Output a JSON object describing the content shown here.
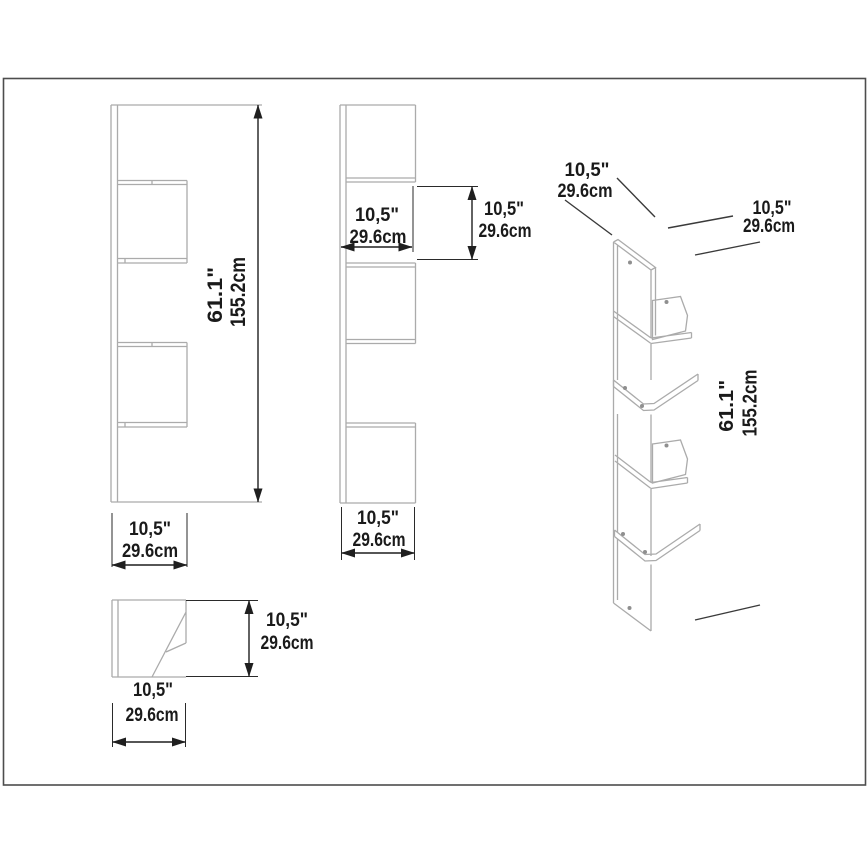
{
  "drawing": {
    "front_view": {
      "height": {
        "inches": "61.1\"",
        "cm": "155.2cm"
      },
      "width": {
        "inches": "10,5\"",
        "cm": "29.6cm"
      }
    },
    "side_view": {
      "shelf_width": {
        "inches": "10,5\"",
        "cm": "29.6cm"
      },
      "shelf_height": {
        "inches": "10,5\"",
        "cm": "29.6cm"
      },
      "bottom_width": {
        "inches": "10,5\"",
        "cm": "29.6cm"
      }
    },
    "top_view": {
      "depth": {
        "inches": "10,5\"",
        "cm": "29.6cm"
      },
      "width": {
        "inches": "10,5\"",
        "cm": "29.6cm"
      }
    },
    "iso_view": {
      "left_depth": {
        "inches": "10,5\"",
        "cm": "29.6cm"
      },
      "right_depth": {
        "inches": "10,5\"",
        "cm": "29.6cm"
      },
      "height": {
        "inches": "61.1\"",
        "cm": "155.2cm"
      }
    },
    "colors": {
      "background": "#ffffff",
      "outline": "#ababab",
      "dimension": "#1f1f1f",
      "frame": "#4d4d4d"
    }
  }
}
